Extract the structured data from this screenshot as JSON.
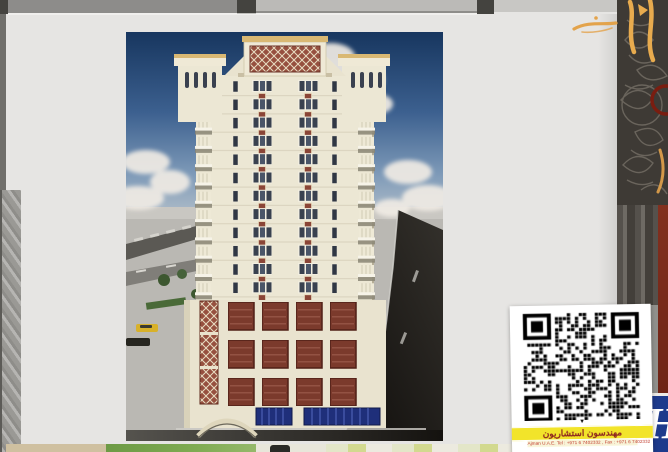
{
  "viewer": {
    "topbar": {
      "color_left_segment": "#8d8c8a",
      "color_mid_segment": "#bbbab7",
      "color_right_segment": "#c8c7c4",
      "handle_color": "#44433f"
    }
  },
  "document_page": {
    "background_color": "#e6e5e3",
    "image_alt": "3D architectural rendering, front elevation of a cream high-rise residential tower with maroon ornamental panels, corner minaret-style turrets, podium with lattice screens and blue glass storefront, blue sky with clouds, street with cars and trees",
    "palette": {
      "sky_blue": "#2a4a78",
      "facade_cream": "#ece7d4",
      "accent_maroon": "#8a4537",
      "cornice_gold": "#d9b873",
      "glass_blue": "#1f2f7a"
    }
  },
  "qr_card": {
    "arrow_glyph": "▼",
    "company_name_ar": "مهندسون استشاريون",
    "contact_line": "Ajman      U.A.E.      Tel : +971 6 7402332 ,  Fax : +971 6 7402332",
    "strip_color": "#f2e42a",
    "text_color": "#8a1f1f"
  },
  "side_band": {
    "base_color": "#3e3a35",
    "calligraphy_gold": "#e3a34b",
    "circle_red": "#7a1d10",
    "maroon_strip": "#76281a",
    "logo_blue": "#1d3a8c",
    "logo_letter": "H"
  }
}
